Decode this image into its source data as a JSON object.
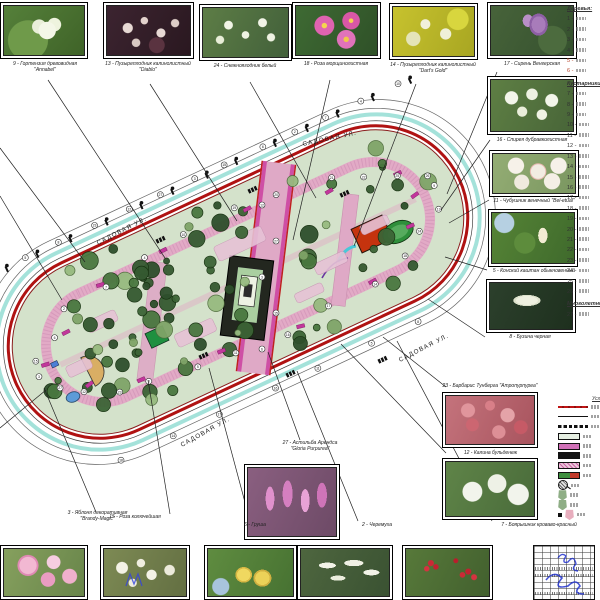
{
  "sheet": {
    "background": "#ffffff"
  },
  "streets": {
    "label": "САДОВАЯ УЛ."
  },
  "photos": {
    "top": [
      {
        "caption": "9 - Гортензия древовидная",
        "caption2": "\"Annabel\""
      },
      {
        "caption": "13 - Пузыреплодник калинолистный",
        "caption2": "\"Diablo\""
      },
      {
        "caption": "24 - Снежноягодник белый",
        "caption2": ""
      },
      {
        "caption": "18 - Роза морщинолистная",
        "caption2": ""
      },
      {
        "caption": "14 - Пузыреплодник калинолистный",
        "caption2": "\"Dart's Gold\""
      },
      {
        "caption": "17 - Сирень Венгерская",
        "caption2": ""
      }
    ],
    "right": [
      {
        "caption": "16 - Спирея дубравколистная"
      },
      {
        "caption": "11 - Чубушник венечный \"Bel-etual\""
      },
      {
        "caption": "5 - Конский каштан обыкновенный"
      },
      {
        "caption": "8 - Бузина черная"
      },
      {
        "caption": "23 - Барбарис Тунберга \"Атропурпуреа\""
      },
      {
        "caption": "12 - Калина бульденеж"
      }
    ],
    "bottom": [
      {
        "caption": "27 - Астильба Арендса",
        "caption2": "\"Gloria Purpurea\""
      },
      {
        "caption": "3 - Яблоня декоративная",
        "caption2": "\"Brandy-Magic\""
      },
      {
        "caption": "15 - Роза колючейшая",
        "caption2": ""
      },
      {
        "caption": "6 - Груша",
        "caption2": ""
      },
      {
        "caption": "2 - Черемуха",
        "caption2": ""
      },
      {
        "caption": "7 - Боярышник кроваво-красный",
        "caption2": ""
      }
    ]
  },
  "species_list": {
    "sections": [
      {
        "title": "Деревья:",
        "start": 1,
        "count": 6,
        "highlight": [
          5,
          6
        ]
      },
      {
        "title": "Кустарники:",
        "start": 7,
        "count": 20,
        "highlight": []
      },
      {
        "title": "Многолетники:",
        "start": 27,
        "count": 1,
        "highlight": []
      }
    ]
  },
  "legend": {
    "title": "Условные обозначения",
    "items": [
      {
        "icon": "red-dashed-line-icon"
      },
      {
        "icon": "solid-line-icon"
      },
      {
        "icon": "black-dashed-line-icon"
      },
      {
        "icon": "lawn-swatch"
      },
      {
        "icon": "flowerbed-swatch"
      },
      {
        "icon": "pavement-swatch"
      },
      {
        "icon": "pink-paving-swatch"
      },
      {
        "icon": "green-red-swatch"
      },
      {
        "icon": "hatched-circle-icon"
      },
      {
        "icon": "green-shield-icon"
      },
      {
        "icon": "green-shield-icon"
      },
      {
        "icon": "pink-shield-icon"
      }
    ]
  },
  "plan": {
    "colors": {
      "boundary_red": "#b01212",
      "path_pink": "#dfa9c6",
      "flowerbed_magenta": "#c2379b",
      "sidewalk_teal": "#86d8ce",
      "lawn_green": "#d4e2cb",
      "tree_green": "#2e4f2c",
      "building_orange": "#c5330e",
      "stamp_blue": "#2233cc"
    },
    "tag_numbers": [
      9,
      13,
      24,
      18,
      14,
      17,
      16,
      11,
      5,
      8,
      23,
      12,
      27,
      3,
      15,
      6,
      2,
      7,
      4,
      10,
      19,
      20,
      21,
      22,
      25,
      26
    ]
  },
  "title_block": {
    "columns": 8,
    "rows": 9
  }
}
